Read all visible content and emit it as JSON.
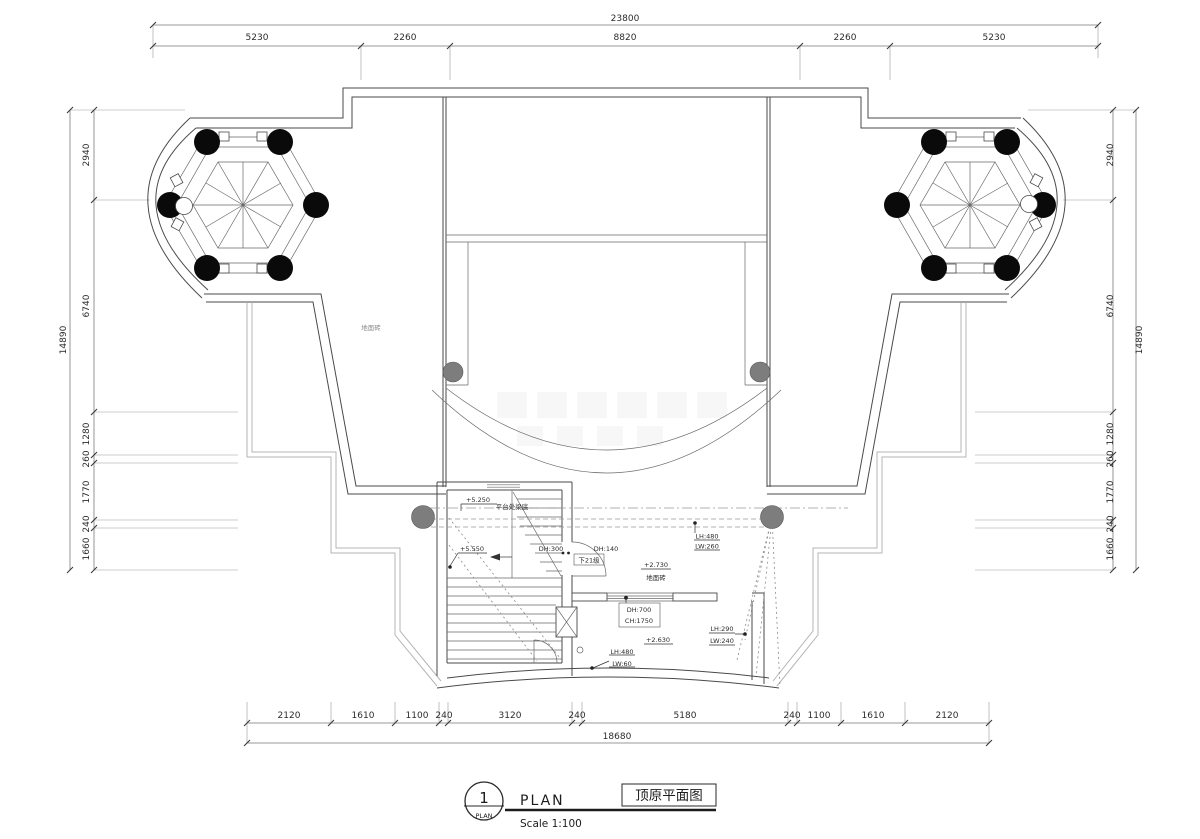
{
  "drawing": {
    "kind": "roof plan (CAD architectural drawing)",
    "colors": {
      "paper": "#ffffff",
      "wall_line": "#4a4a4a",
      "terrace_outline": "#b5b5b5",
      "dimension_line": "#7a7a7a",
      "column_fill": "#0a0a0a",
      "gray_column_fill": "#7d7d7d",
      "annotation_text": "#2b2b2b"
    }
  },
  "dims": {
    "top": {
      "total": "23800",
      "segments": [
        "5230",
        "2260",
        "8820",
        "2260",
        "5230"
      ]
    },
    "bottom": {
      "total": "18680",
      "segments": [
        "2120",
        "1610",
        "1100",
        "240",
        "3120",
        "240",
        "5180",
        "240",
        "1100",
        "1610",
        "2120"
      ]
    },
    "left": {
      "total": "14890",
      "segments": [
        "2940",
        "6740",
        "1280",
        "260",
        "1770",
        "240",
        "1660"
      ]
    },
    "right": {
      "total": "14890",
      "segments": [
        "2940",
        "6740",
        "1280",
        "260",
        "1770",
        "240",
        "1660"
      ]
    }
  },
  "labels": {
    "floor_tile_left": "地面砖",
    "level_beam": "+5.250",
    "beam_note": "平台处梁底",
    "level_landing": "+5.550",
    "dh300": "DH:300",
    "dh140": "DH:140",
    "steps_down": "下21级",
    "level_2730": "+2.730",
    "floor_tile_mid": "地面砖",
    "lh480_top": "LH:480",
    "lw260": "LW:260",
    "dh700": "DH:700",
    "ch1750": "CH:1750",
    "level_2630": "+2.630",
    "lh290": "LH:290",
    "lw240": "LW:240",
    "lh480_bottom": "LH:480",
    "lw60": "LW:60"
  },
  "title_block": {
    "index": "1",
    "index_sub": "PLAN",
    "name_en": "PLAN",
    "scale": "Scale 1:100",
    "name_cn": "顶原平面图"
  }
}
